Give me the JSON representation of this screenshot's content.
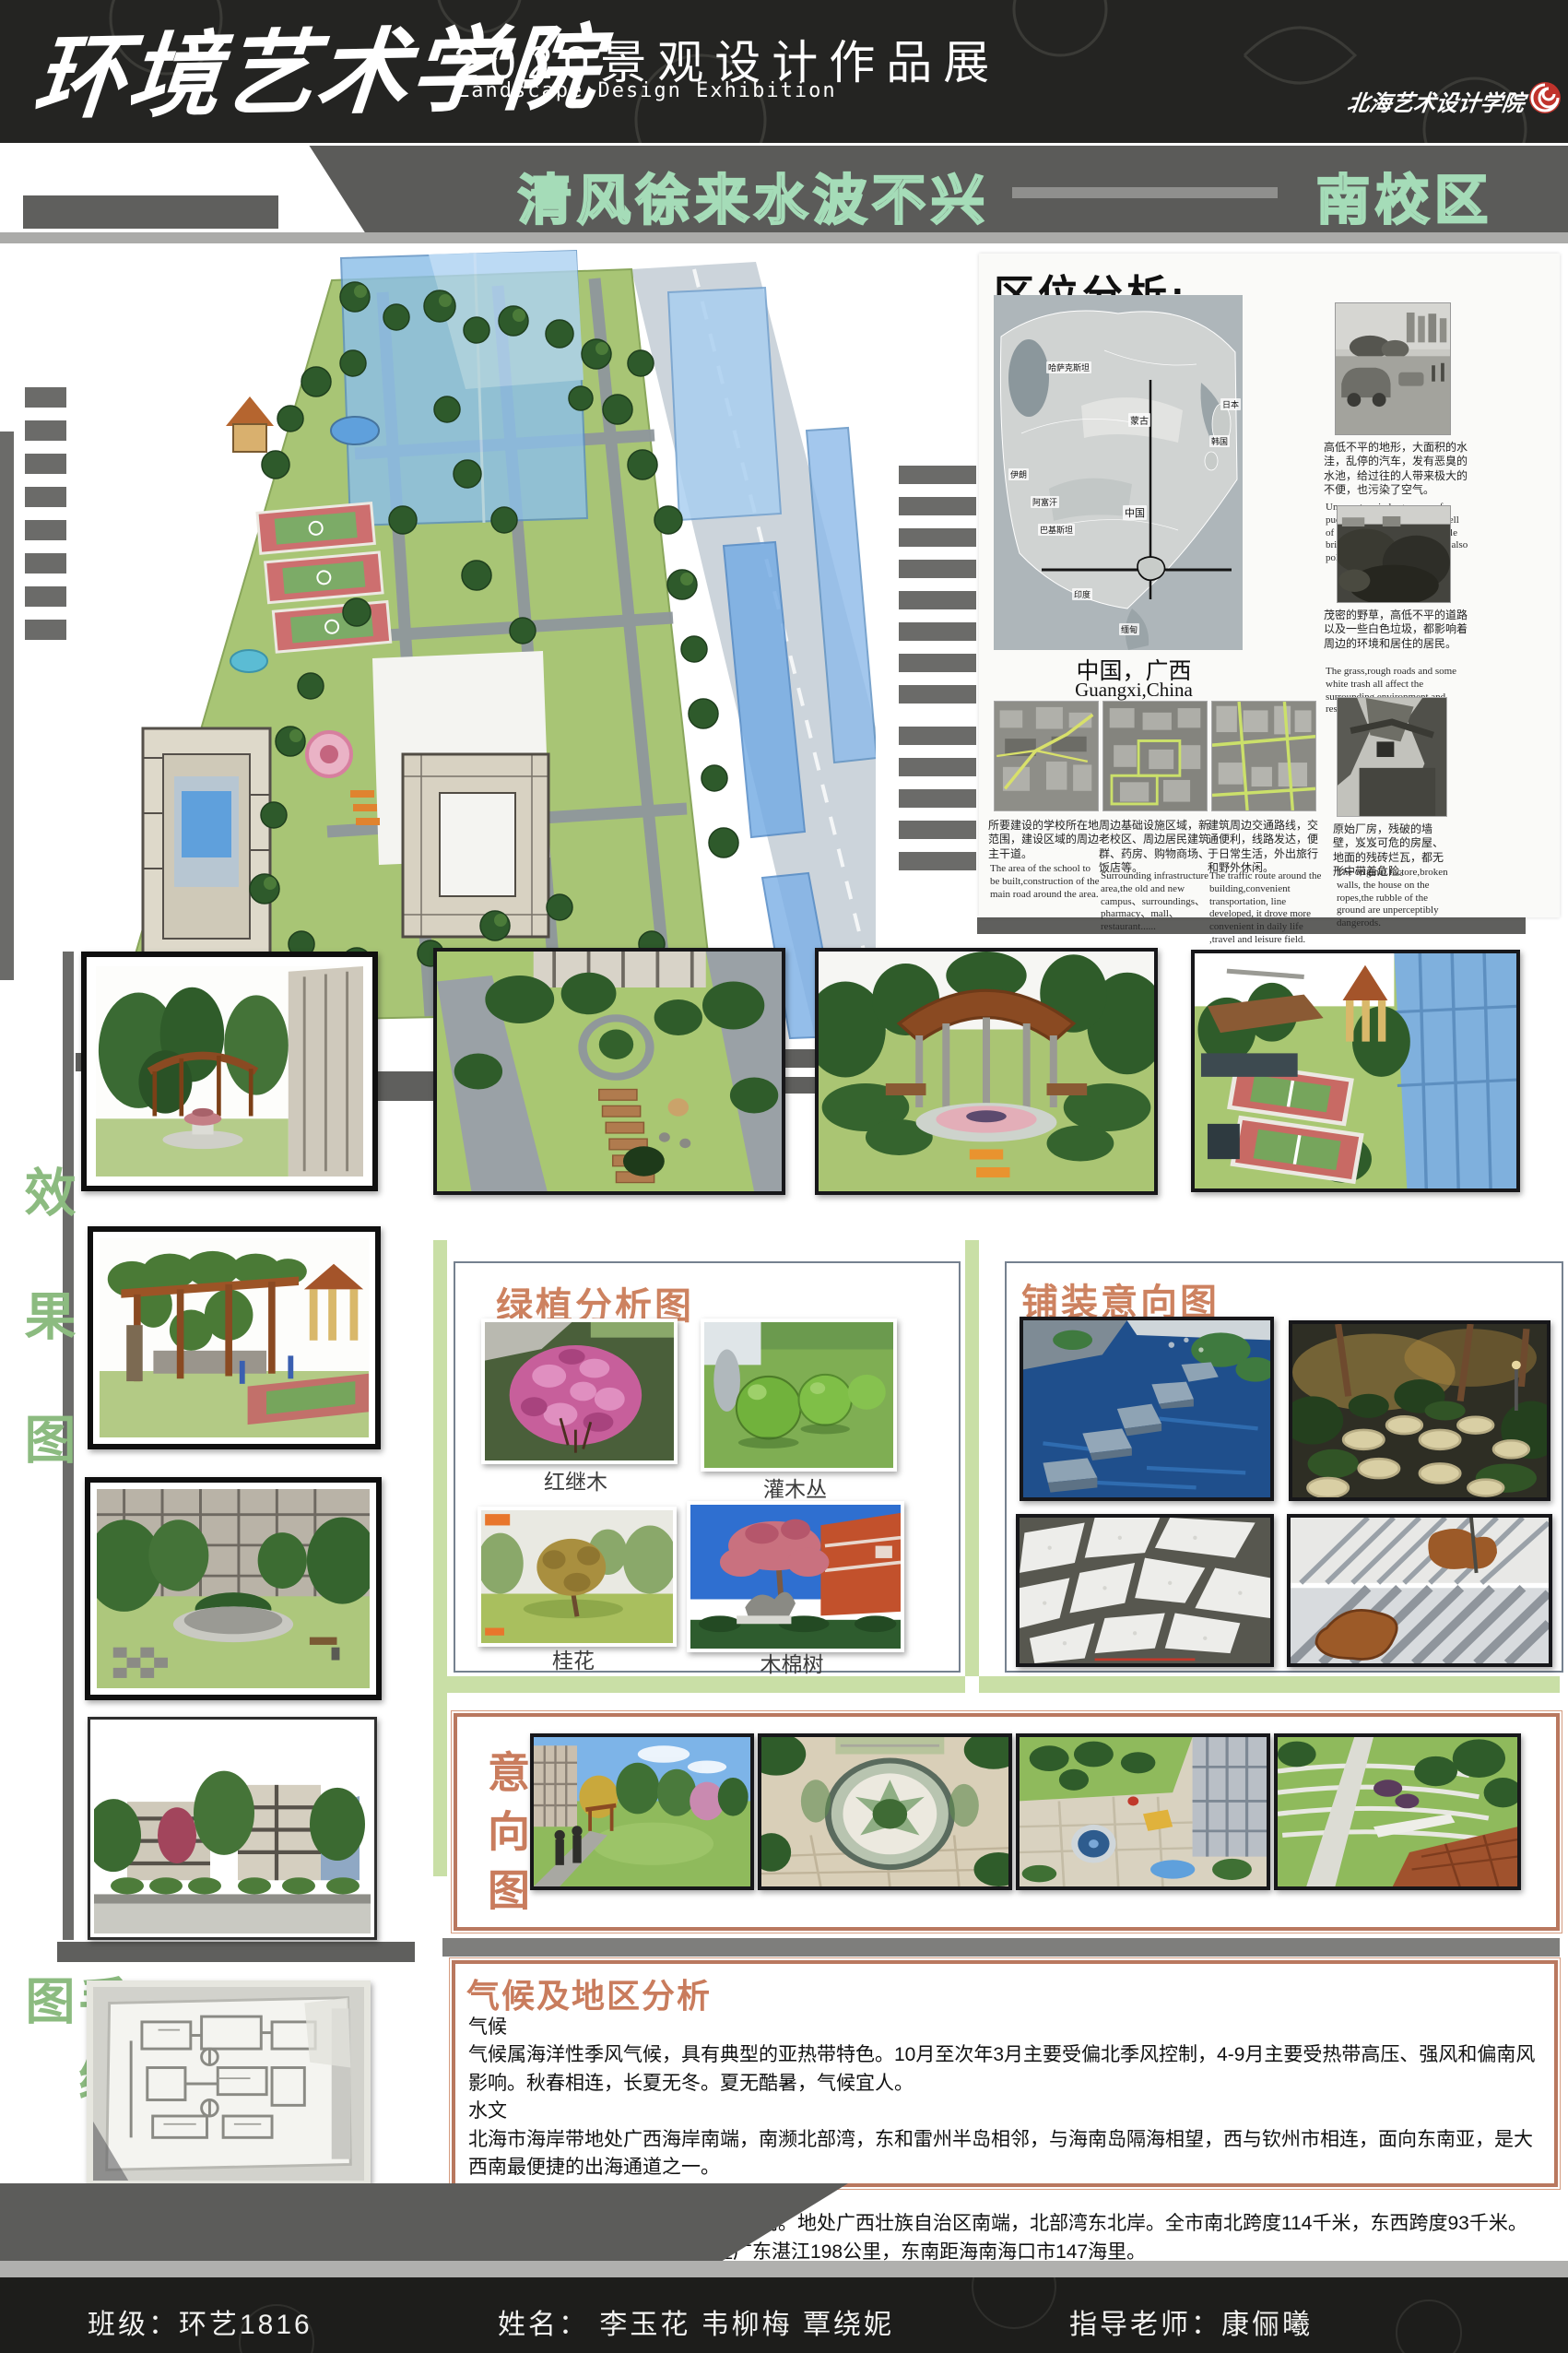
{
  "header": {
    "school": "环境艺术学院",
    "title_cn": "2020景观设计作品展",
    "title_en": "Landscape Design Exhibition",
    "logo_text": "北海艺术设计学院"
  },
  "banner": {
    "slogan": "清风徐来水波不兴",
    "campus": "南校区"
  },
  "location": {
    "title": "区位分析:",
    "map_caption_cn": "中国，广西",
    "map_caption_en": "Guangxi,China",
    "map_labels": [
      "哈萨克斯坦",
      "蒙古",
      "中国",
      "伊朗",
      "阿富汗",
      "巴基斯坦",
      "印度",
      "缅甸",
      "日本",
      "韩国"
    ],
    "photos": [
      {
        "cn": "高低不平的地形，大面积的水洼，乱停的汽车，发有恶臭的水池，给过往的人带来极大的不便，也污染了空气。",
        "en": "Uneven terrain large areas of puddles, parked cars,a foul smell of the pool,to the passing people bring great inconvenience, but also pollution of the environment."
      },
      {
        "cn": "茂密的野草，高低不平的道路以及一些白色垃圾，都影响着周边的环境和居住的居民。",
        "en": "The grass,rough roads and some white trash all affect the surrounding environment and residents."
      }
    ],
    "thumbs": [
      {
        "cn": "所要建设的学校所在地范围，建设区域的周边主干道。",
        "en": "The area of the school to be built,construction of the main road around the area."
      },
      {
        "cn": "周边基础设施区域，新老校区、周边居民建筑群、药房、购物商场、饭店等。",
        "en": "Surrounding infrastructure area,the old and new campus、surroundings、pharmacy、mall、restaurant......"
      },
      {
        "cn": "建筑周边交通路线，交通便利，线路发达，便于日常生活，外出旅行和野外休闲。",
        "en": "The traffic route around the building,convenient transportation, line developed, it drove more convenient in daily life ,travel and leisure field."
      },
      {
        "cn": "原始厂房，残破的墙壁，岌岌可危的房屋、地面的残砖烂瓦，都无形中带着危险。",
        "en": "The original factore,broken walls, the house on the ropes,the rubble of the ground are unperceptibly dangerods."
      }
    ]
  },
  "effect": {
    "label": "效果图"
  },
  "sketch": {
    "label": "手绘图"
  },
  "plants": {
    "title": "绿植分析图",
    "items": [
      "红继木",
      "灌木丛",
      "桂花",
      "木棉树"
    ]
  },
  "paving": {
    "title": "铺装意向图"
  },
  "intent": {
    "label": "意向图"
  },
  "climate": {
    "title": "气候及地区分析",
    "lines": [
      "气候",
      "气候属海洋性季风气候，具有典型的亚热带特色。10月至次年3月主要受偏北季风控制，4-9月主要受热带高压、强风和偏南风影响。秋春相连，长夏无冬。夏无酷暑，气候宜人。",
      "水文",
      "北海市海岸带地处广西海岸南端，南濒北部湾，东和雷州半岛相邻，与海南岛隔海相望，西与钦州市相连，面向东南亚，是大西南最便捷的出海通道之一。",
      "地势",
      "地势总体呈北高南低，地势平坦开阔。地处广西壮族自治区南端，北部湾东北岸。全市南北跨度114千米，东西跨度93千米。西北距首府南宁206公里，东距广东湛江198公里，东南距海南海口市147海里。"
    ]
  },
  "footer": {
    "class_label": "班级：环艺1816",
    "names_label": "姓名：  李玉花  韦柳梅  覃绕妮",
    "teacher_label": "指导老师：康俪曦"
  }
}
